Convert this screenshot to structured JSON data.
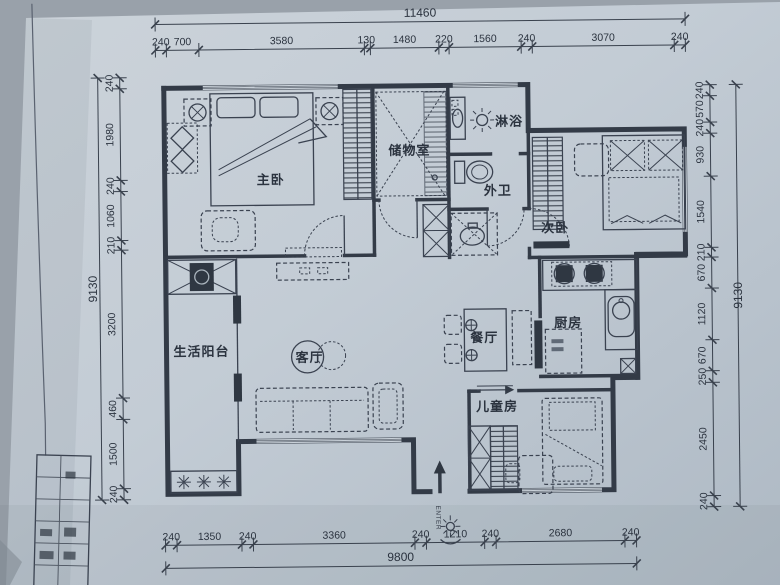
{
  "labels": {
    "master": "主卧",
    "storage": "储物室",
    "shower": "淋浴",
    "bath": "外卫",
    "second": "次卧",
    "kitchen": "厨房",
    "dining": "餐厅",
    "living": "客厅",
    "balcony": "生活阳台",
    "kids": "儿童房",
    "enter": "ENTER"
  },
  "dims": {
    "top": {
      "total": "11460",
      "segs": [
        "240",
        "700",
        "3580",
        "130",
        "1480",
        "220",
        "1560",
        "240",
        "3070",
        "240"
      ]
    },
    "bottom": {
      "total": "9800",
      "segs": [
        "240",
        "1350",
        "240",
        "3360",
        "240",
        "1210",
        "240",
        "2680",
        "240"
      ]
    },
    "left": {
      "total": "9130",
      "segs": [
        "240",
        "1980",
        "240",
        "1060",
        "210",
        "3200",
        "460",
        "1500",
        "240"
      ]
    },
    "right": {
      "total": "9130",
      "segs": [
        "240",
        "570",
        "240",
        "930",
        "1540",
        "210",
        "670",
        "1120",
        "670",
        "250",
        "2450",
        "240"
      ]
    }
  },
  "colors": {
    "paper": "#c3ccd5",
    "ink": "#323a46"
  }
}
